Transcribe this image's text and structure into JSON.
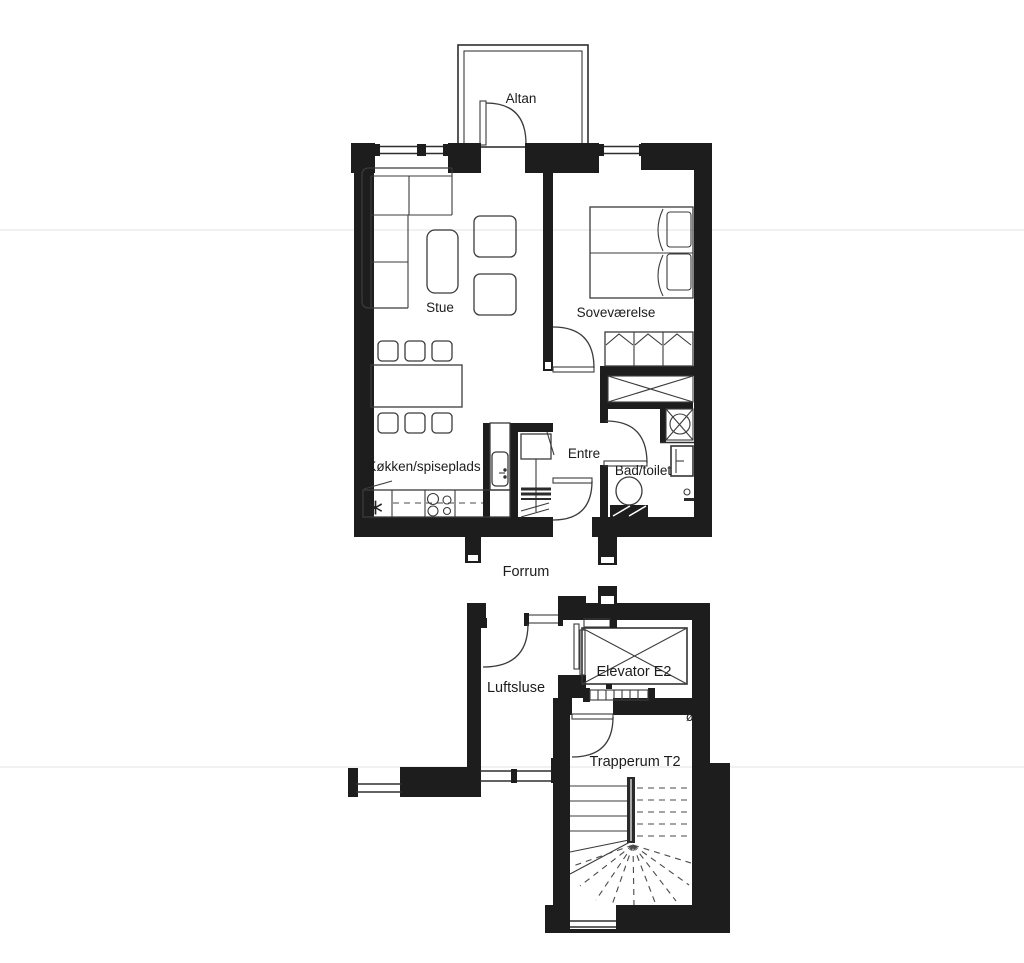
{
  "document": {
    "type": "architectural-floor-plan",
    "language": "da"
  },
  "colors": {
    "wall": "#1d1d1d",
    "line": "#3b3b3b",
    "text": "#1c1c1c",
    "background": "#ffffff"
  },
  "plan": {
    "labels": {
      "altan": "Altan",
      "stue": "Stue",
      "sovevaerelse": "Soveværelse",
      "koekken": "Køkken/spiseplads",
      "entre": "Entre",
      "bad": "Bad/toilet",
      "forrum": "Forrum",
      "luftsluse": "Luftsluse",
      "elevator": "Elevator E2",
      "trapperum": "Trapperum T2"
    },
    "symbols": {
      "cooker_asterisk": "*",
      "drain": "ø"
    }
  }
}
